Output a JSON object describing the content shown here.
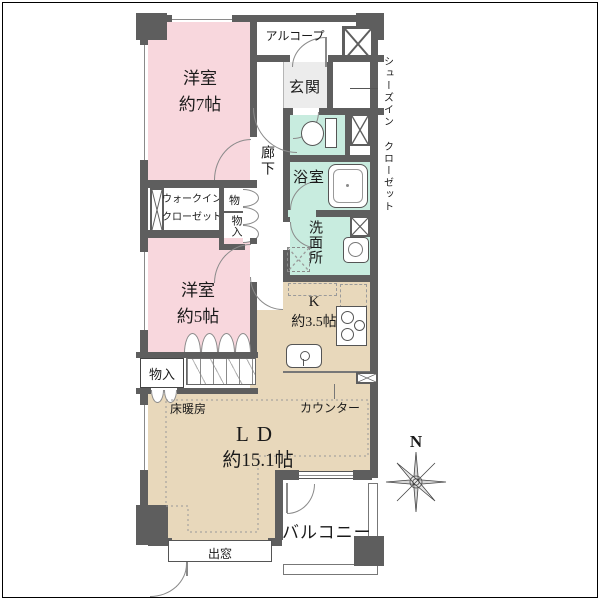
{
  "plan": {
    "rooms": {
      "bedroom7": {
        "name": "洋室",
        "size": "約7帖"
      },
      "bedroom5": {
        "name": "洋室",
        "size": "約5帖"
      },
      "living": {
        "name": "LD",
        "size": "約15.1帖"
      },
      "kitchen": {
        "name": "K",
        "size": "約3.5帖"
      },
      "entrance": "玄関",
      "alcove": "アルコープ",
      "hallway": "廊下",
      "bathroom": "浴室",
      "washroom": "洗面所",
      "balcony": "バルコニー"
    },
    "storage": {
      "wic_line1": "ウォークイン",
      "wic_line2": "クローゼット",
      "sic_col1": "シューズイン",
      "sic_col2": "クローゼット",
      "hall_closet_top": "物",
      "hall_closet_bottom": "物入",
      "ld_closet": "物入"
    },
    "annotations": {
      "floor_heating": "床暖房",
      "counter": "カウンター",
      "bay_window": "出窓",
      "compass": "N"
    },
    "colors": {
      "wall": "#5e5e5e",
      "bedroom_fill": "#f8d7dd",
      "wet_area_fill": "#c8ecdf",
      "living_fill": "#e8d8bb",
      "entrance_floor": "#ececec"
    }
  }
}
